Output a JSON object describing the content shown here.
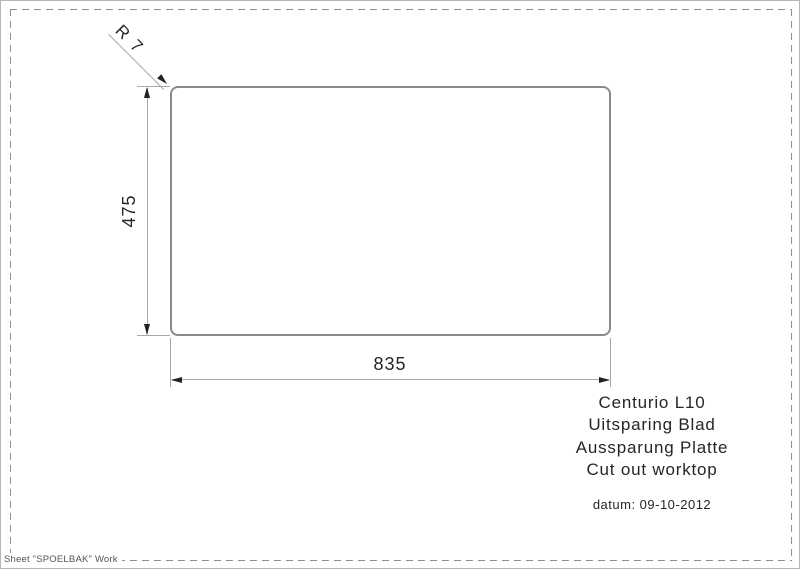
{
  "drawing": {
    "type": "cut-out dimension drawing",
    "dimensions": {
      "width_label": "835",
      "height_label": "475",
      "corner_radius_label": "R 7"
    }
  },
  "title_block": {
    "lines": [
      "Centurio L10",
      "Uitsparing Blad",
      "Aussparung Platte",
      "Cut out worktop"
    ],
    "date": "datum: 09-10-2012"
  },
  "footer": {
    "sheet_label": "Sheet \"SPOELBAK\" Work"
  },
  "colors": {
    "outline_gray": "#8a8a8a",
    "dimension_line_gray": "#a8a8a8",
    "arrow_black": "#222222",
    "text_color": "#262626",
    "dash_border_gray": "#8f8f8f"
  }
}
